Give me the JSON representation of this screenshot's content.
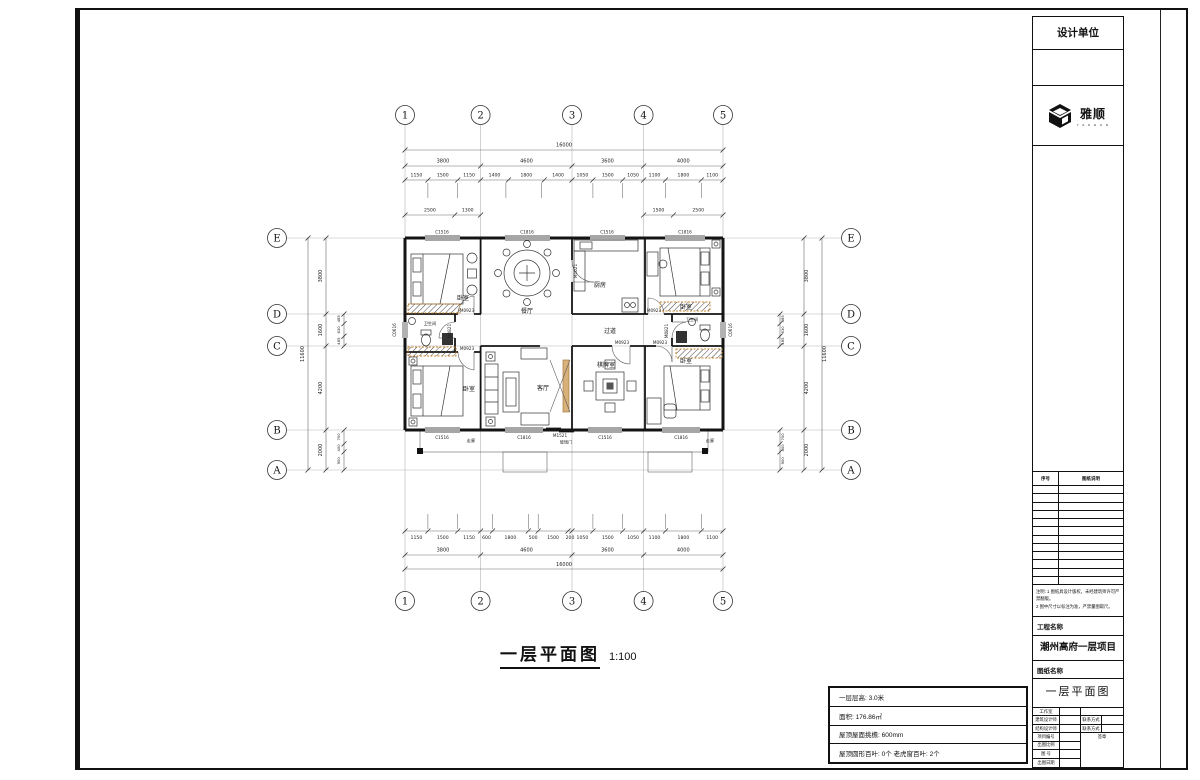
{
  "tb": {
    "design_unit": "设计单位",
    "logo_text": "雅顺",
    "logo_sub": "Y A S H U N",
    "list_header": {
      "no": "序号",
      "desc": "图纸说明"
    },
    "notes_line1": "注明: 1 图纸具设计版权，未经建筑师许可严禁翻版。",
    "notes_line2": "2 图中尺寸以标注为准，严禁量图取尺。",
    "project_label": "工程名称",
    "project_name": "潮州高府一层项目",
    "drawing_label": "图纸名称",
    "drawing_name": "一层平面图",
    "fields": {
      "studio": "工作室",
      "arch": "建筑设计师",
      "contact1": "联系方式",
      "struct": "结构设计师",
      "contact2": "联系方式",
      "project_no": "项目编号",
      "seal": "签章",
      "scale": "出图比例",
      "fig_no": "图 号",
      "date": "出图日期"
    }
  },
  "ib": {
    "rows": [
      "一层层高: 3.0米",
      "面积: 176.86㎡",
      "屋顶屋面挑檐: 600mm",
      "屋顶圆形百叶: 0个   老虎窗百叶: 2个"
    ]
  },
  "pt": {
    "text": "一层平面图",
    "scale": "1:100"
  },
  "grid": {
    "cols": [
      "1",
      "2",
      "3",
      "4",
      "5"
    ],
    "rows": [
      "E",
      "D",
      "C",
      "B",
      "A"
    ]
  },
  "dims": {
    "top": {
      "total": "16000",
      "major": [
        "3800",
        "4600",
        "3600",
        "4000"
      ],
      "minor": [
        "1150",
        "1500",
        "1150",
        "1400",
        "1800",
        "1400",
        "1050",
        "1500",
        "1050",
        "1100",
        "1800",
        "1100"
      ],
      "partial_left": [
        "2500",
        "1300"
      ],
      "partial_right": [
        "1500",
        "2500"
      ]
    },
    "bottom": {
      "total": "16000",
      "major": [
        "3800",
        "4600",
        "3600",
        "4000"
      ],
      "minor": [
        "1150",
        "1500",
        "1150",
        "600",
        "1800",
        "500",
        "1500",
        "200",
        "1050",
        "1500",
        "1050",
        "1100",
        "1800",
        "1100"
      ]
    },
    "left": {
      "total": "11600",
      "major": [
        "3800",
        "1600",
        "4200",
        "2000"
      ],
      "minor_dc": [
        "485",
        "630",
        "485"
      ],
      "minor_ba": [
        "700",
        "400",
        "900"
      ]
    },
    "right": {
      "total": "11600",
      "major": [
        "3800",
        "1600",
        "4200",
        "2000"
      ],
      "minor_dc": [
        "485",
        "630",
        "485"
      ],
      "minor_ba": [
        "700",
        "400",
        "900"
      ]
    }
  },
  "rooms": {
    "bedroom": "卧室",
    "dining": "餐厅",
    "kitchen": "厨房",
    "living": "客厅",
    "mahjong": "棋牌室",
    "hall": "过道",
    "bath": "卫生间",
    "veranda": "走廊"
  },
  "op": {
    "c1516": "C1516",
    "c1816": "C1816",
    "c0616": "C0616",
    "m0923": "M0923",
    "m0821": "M0821",
    "m1021": "M1021",
    "m1521": "M1521",
    "glass_door": "玻璃门"
  },
  "colors": {
    "hatch_border": "#c8842a",
    "wood": "#d8b07a",
    "wall": "#141414",
    "grid_line": "#b5b5b5"
  }
}
